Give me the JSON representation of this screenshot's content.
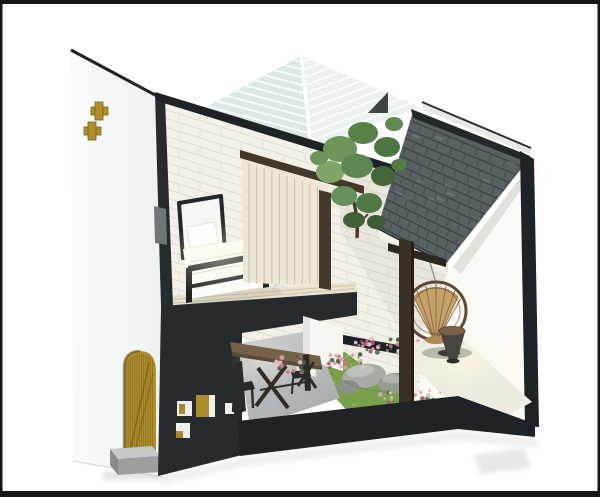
{
  "scene": {
    "description": "Isometric 3D cut-away render of a compact two-storey house: white bedroom with bed and wardrobe upstairs, dining nook and green courtyard with boulders and flowers below, gray shingle roof over a patio with a round rattan chair, white louvered skylight, charcoal cut walls, and a brass arched door with cross-shaped cutouts in the white side wall.",
    "canvas": {
      "width": 600,
      "height": 497
    },
    "palette": {
      "bg": "#ffffff",
      "frame": "#161616",
      "wall_white": "#f8fbf9",
      "wall_shade": "#edf2ef",
      "gold": "#b08e2e",
      "charcoal": "#262c2e",
      "charcoal_deep": "#1d2326",
      "brick": "#f3f0e8",
      "wood_floor": "#e8e1cf",
      "wardrobe": "#ece6d7",
      "bedding": "#fcfbf8",
      "bed_frame": "#202326",
      "skylight_left": "#dce7e8",
      "skylight_right": "#eaf1f1",
      "shingle": "#596165",
      "ridge": "#23282a",
      "fascia": "#f1f0ea",
      "gable": "#fbf9f4",
      "grass": "#79a14c",
      "stone": "#a6aba4",
      "rattan": "#c7a268",
      "rattan_ring": "#5d4833",
      "wood_table": "#76604a",
      "timber": "#43382a",
      "patio": "#edebe0",
      "stair": "#f7f6f1",
      "step_top": "#c6cac6",
      "step_front": "#9ba09d"
    },
    "objects": [
      {
        "name": "left-gable-wall",
        "detail": "white side wall, two brass cross cutouts"
      },
      {
        "name": "arched-brass-door",
        "detail": "gold arched door with grain lines"
      },
      {
        "name": "stone-doorstep",
        "detail": "gray entry step"
      },
      {
        "name": "louvered-skylight",
        "detail": "white slatted hip skylight with dark vent"
      },
      {
        "name": "courtyard-tree",
        "detail": "green tree between roofs"
      },
      {
        "name": "shingle-roof",
        "detail": "gray slate shingle roof with dark ridge"
      },
      {
        "name": "right-gable-wall",
        "detail": "white interior gable over patio"
      },
      {
        "name": "bedroom-bed",
        "detail": "white bed, dark metal frame, pillows"
      },
      {
        "name": "wardrobe",
        "detail": "cream paneled closet with timber frame"
      },
      {
        "name": "floor-slab",
        "detail": "charcoal slab band between storeys"
      },
      {
        "name": "front-wall-niches",
        "detail": "small square niches, white and brass"
      },
      {
        "name": "dining-table",
        "detail": "wood table with X legs and two dark chairs"
      },
      {
        "name": "staircase",
        "detail": "white stair block"
      },
      {
        "name": "courtyard-grass",
        "detail": "green lawn with boulders and pink flowers"
      },
      {
        "name": "raised-patio",
        "detail": "bright stone patio"
      },
      {
        "name": "hanging-rattan-chair",
        "detail": "round woven chair"
      },
      {
        "name": "cone-side-table",
        "detail": "dark cone stool with wood top"
      },
      {
        "name": "roof-post",
        "detail": "dark timber post under roof"
      },
      {
        "name": "base-platform",
        "detail": "charcoal plinth edge"
      },
      {
        "name": "photo-frame-border",
        "detail": "thin black picture border"
      }
    ],
    "textures": {
      "skylight_slats": 11,
      "brick_rows": 34,
      "brick_joint_cols": 7,
      "shingle_rows": 13,
      "shingle_tabs": 8,
      "wardrobe_panel_step": 7.6,
      "grass_dots": 85,
      "door_grain_step": 2.2,
      "flower_clusters": [
        [
          345,
          362,
          36,
          14,
          26
        ],
        [
          391,
          347,
          74,
          16,
          44
        ],
        [
          413,
          400,
          66,
          20,
          44
        ],
        [
          290,
          363,
          28,
          24,
          24
        ]
      ],
      "flower_colors": [
        "#c4798b",
        "#a95c71",
        "#d9a2ae",
        "#e6bcc5",
        "#54714a",
        "#475f3c"
      ],
      "grass_dot_colors": [
        "#678f3f",
        "#8fb65f"
      ]
    }
  }
}
